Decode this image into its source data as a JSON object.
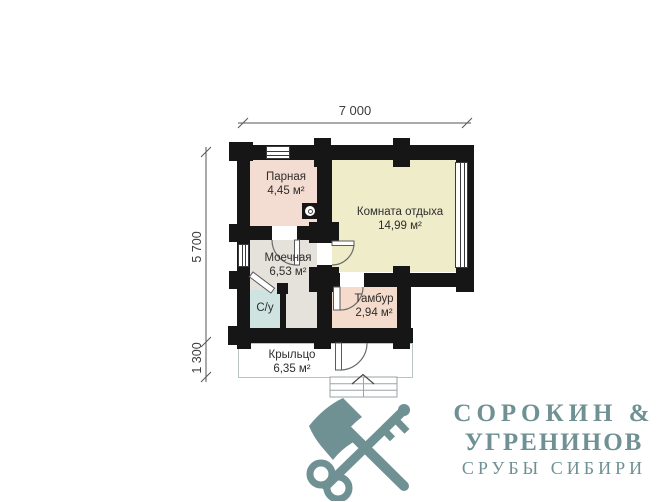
{
  "dimensions": {
    "top": "7 000",
    "left_main": "5 700",
    "left_porch": "1 300"
  },
  "rooms": [
    {
      "name": "Парная",
      "area": "4,45 м²"
    },
    {
      "name": "Комната отдыха",
      "area": "14,99 м²"
    },
    {
      "name": "Моечная",
      "area": "6,53 м²"
    },
    {
      "name": "С/у",
      "area": ""
    },
    {
      "name": "Тамбур",
      "area": "2,94 м²"
    },
    {
      "name": "Крыльцо",
      "area": "6,35 м²"
    }
  ],
  "colors": {
    "wall": "#161616",
    "room_parnaya": "#f3dcd1",
    "room_komnata": "#efecca",
    "room_moechnaya": "#e4e2da",
    "room_su": "#cfe3e1",
    "room_tambur": "#f5dbcb",
    "logo": "#6f9193"
  },
  "icons": {
    "stove": "stove-icon",
    "stairs_arrow": "stairs-up-arrow-icon",
    "logo_mark": "crossed-axe-and-key-icon"
  },
  "logo": {
    "line1": "СОРОКИН &",
    "line2": "УГРЕНИНОВ",
    "line3": "СРУБЫ СИБИРИ"
  }
}
